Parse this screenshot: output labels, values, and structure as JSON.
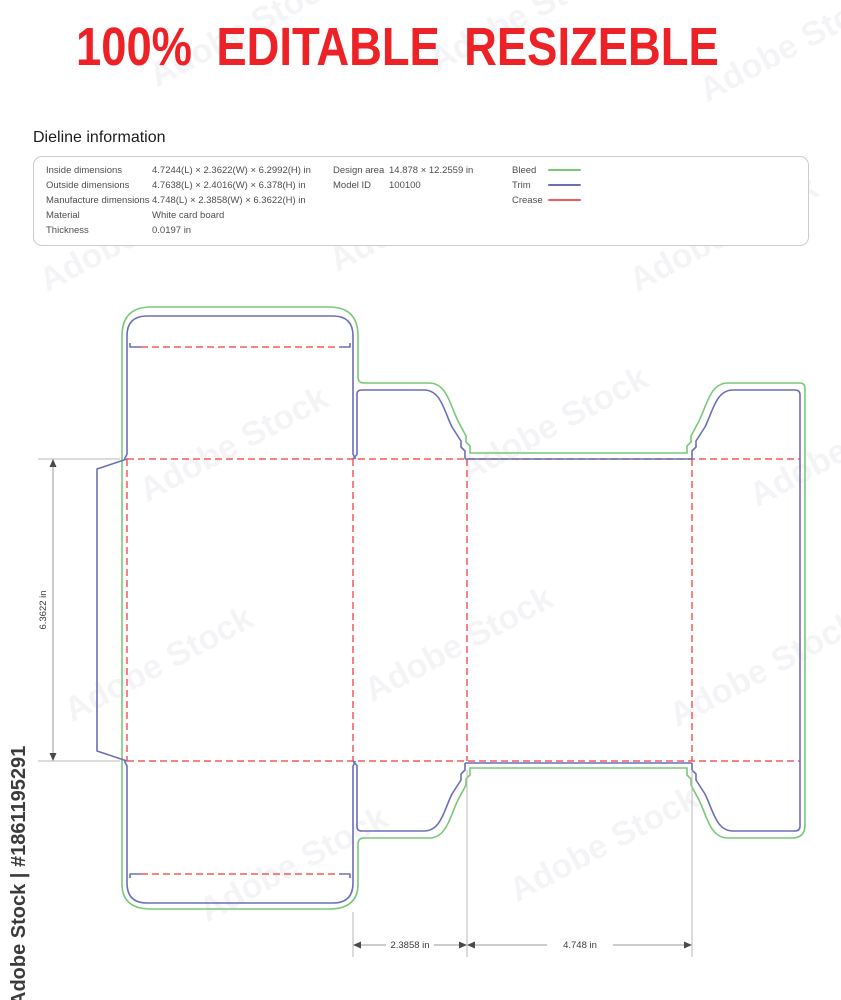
{
  "headline": {
    "text": "100% EDITABLE RESIZEBLE",
    "color": "#ed2227"
  },
  "info": {
    "heading": "Dieline information",
    "col1": [
      {
        "label": "Inside dimensions",
        "value": "4.7244(L) × 2.3622(W) × 6.2992(H) in"
      },
      {
        "label": "Outside dimensions",
        "value": "4.7638(L) × 2.4016(W) × 6.378(H) in"
      },
      {
        "label": "Manufacture dimensions",
        "value": "4.748(L) × 2.3858(W) × 6.3622(H) in"
      },
      {
        "label": "Material",
        "value": "White card board"
      },
      {
        "label": "Thickness",
        "value": "0.0197 in"
      }
    ],
    "col2": [
      {
        "label": "Design area",
        "value": "14.878 × 12.2559 in"
      },
      {
        "label": "Model ID",
        "value": "100100"
      }
    ],
    "legend": [
      {
        "label": "Bleed",
        "color": "#79c979"
      },
      {
        "label": "Trim",
        "color": "#6b6fb8"
      },
      {
        "label": "Crease",
        "color": "#f25b5b"
      }
    ]
  },
  "dieline": {
    "line_colors": {
      "bleed": "#79c979",
      "trim": "#6b6fb8",
      "crease": "#f25b5b"
    },
    "dims": {
      "height": "6.3622 in",
      "side_width": "2.3858 in",
      "front_width": "4.748 in"
    }
  },
  "watermark": {
    "pattern": "Adobe Stock",
    "stamp": "Adobe Stock | #1861195291"
  }
}
